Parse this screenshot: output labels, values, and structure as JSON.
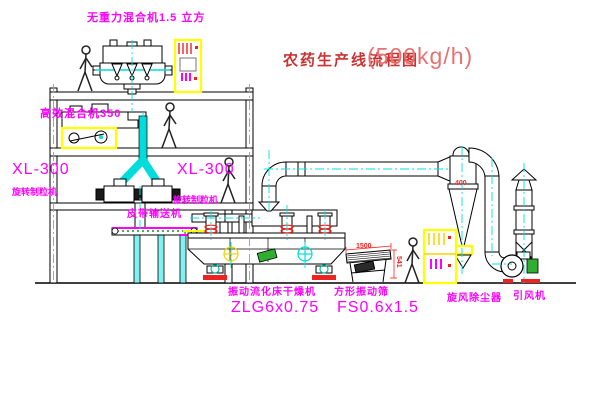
{
  "title": {
    "text": "农药生产线流程图",
    "capacity": "(500kg/h)"
  },
  "equipment_labels": {
    "gravity_mixer": "无重力混合机1.5 立方",
    "high_eff_mixer": "高效混合机350",
    "granulator_left_model": "XL-300",
    "granulator_left_name": "旋转制粒机",
    "granulator_mid_model": "XL-300",
    "granulator_mid_name": "旋转制粒机",
    "belt_conveyor": "皮带输送机",
    "dryer_name": "振动流化床干燥机",
    "dryer_model": "ZLG6x0.75",
    "screen_name": "方形振动筛",
    "screen_model": "FS0.6x1.5",
    "cyclone_name": "旋风除尘器",
    "fan_name": "引风机"
  },
  "dimensions": {
    "screen_length": "1500",
    "screen_height": "541",
    "cyclone_inlet": "400"
  },
  "colors": {
    "label_magenta": "#ff00ff",
    "title_red": "#cc3232",
    "capacity_red": "#e87272",
    "dimension_red": "#ff2222",
    "highlight_yellow": "#ffff00",
    "centerline_cyan": "#00e0e0",
    "pipe_cyan": "#00dcdc",
    "motor_green": "#2fae2f",
    "base_red": "#ee2222"
  }
}
